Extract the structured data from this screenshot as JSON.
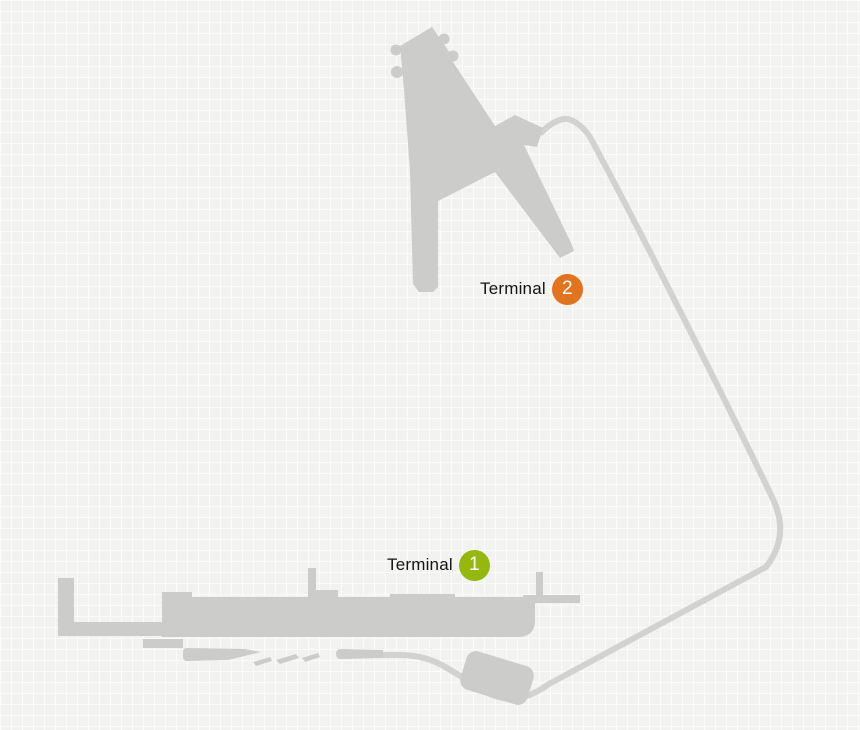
{
  "map": {
    "type": "airport-terminal-map",
    "markers": [
      {
        "id": "terminal-2",
        "label": "Terminal",
        "number": "2",
        "badge_color": "#e2741d"
      },
      {
        "id": "terminal-1",
        "label": "Terminal",
        "number": "1",
        "badge_color": "#94b80e"
      }
    ],
    "colors": {
      "background": "#f2f2f0",
      "grid_line": "#fbfbfa",
      "building": "#ccccca",
      "road": "#d2d2d0",
      "label_text": "#141414",
      "badge_text": "#ffffff"
    }
  }
}
